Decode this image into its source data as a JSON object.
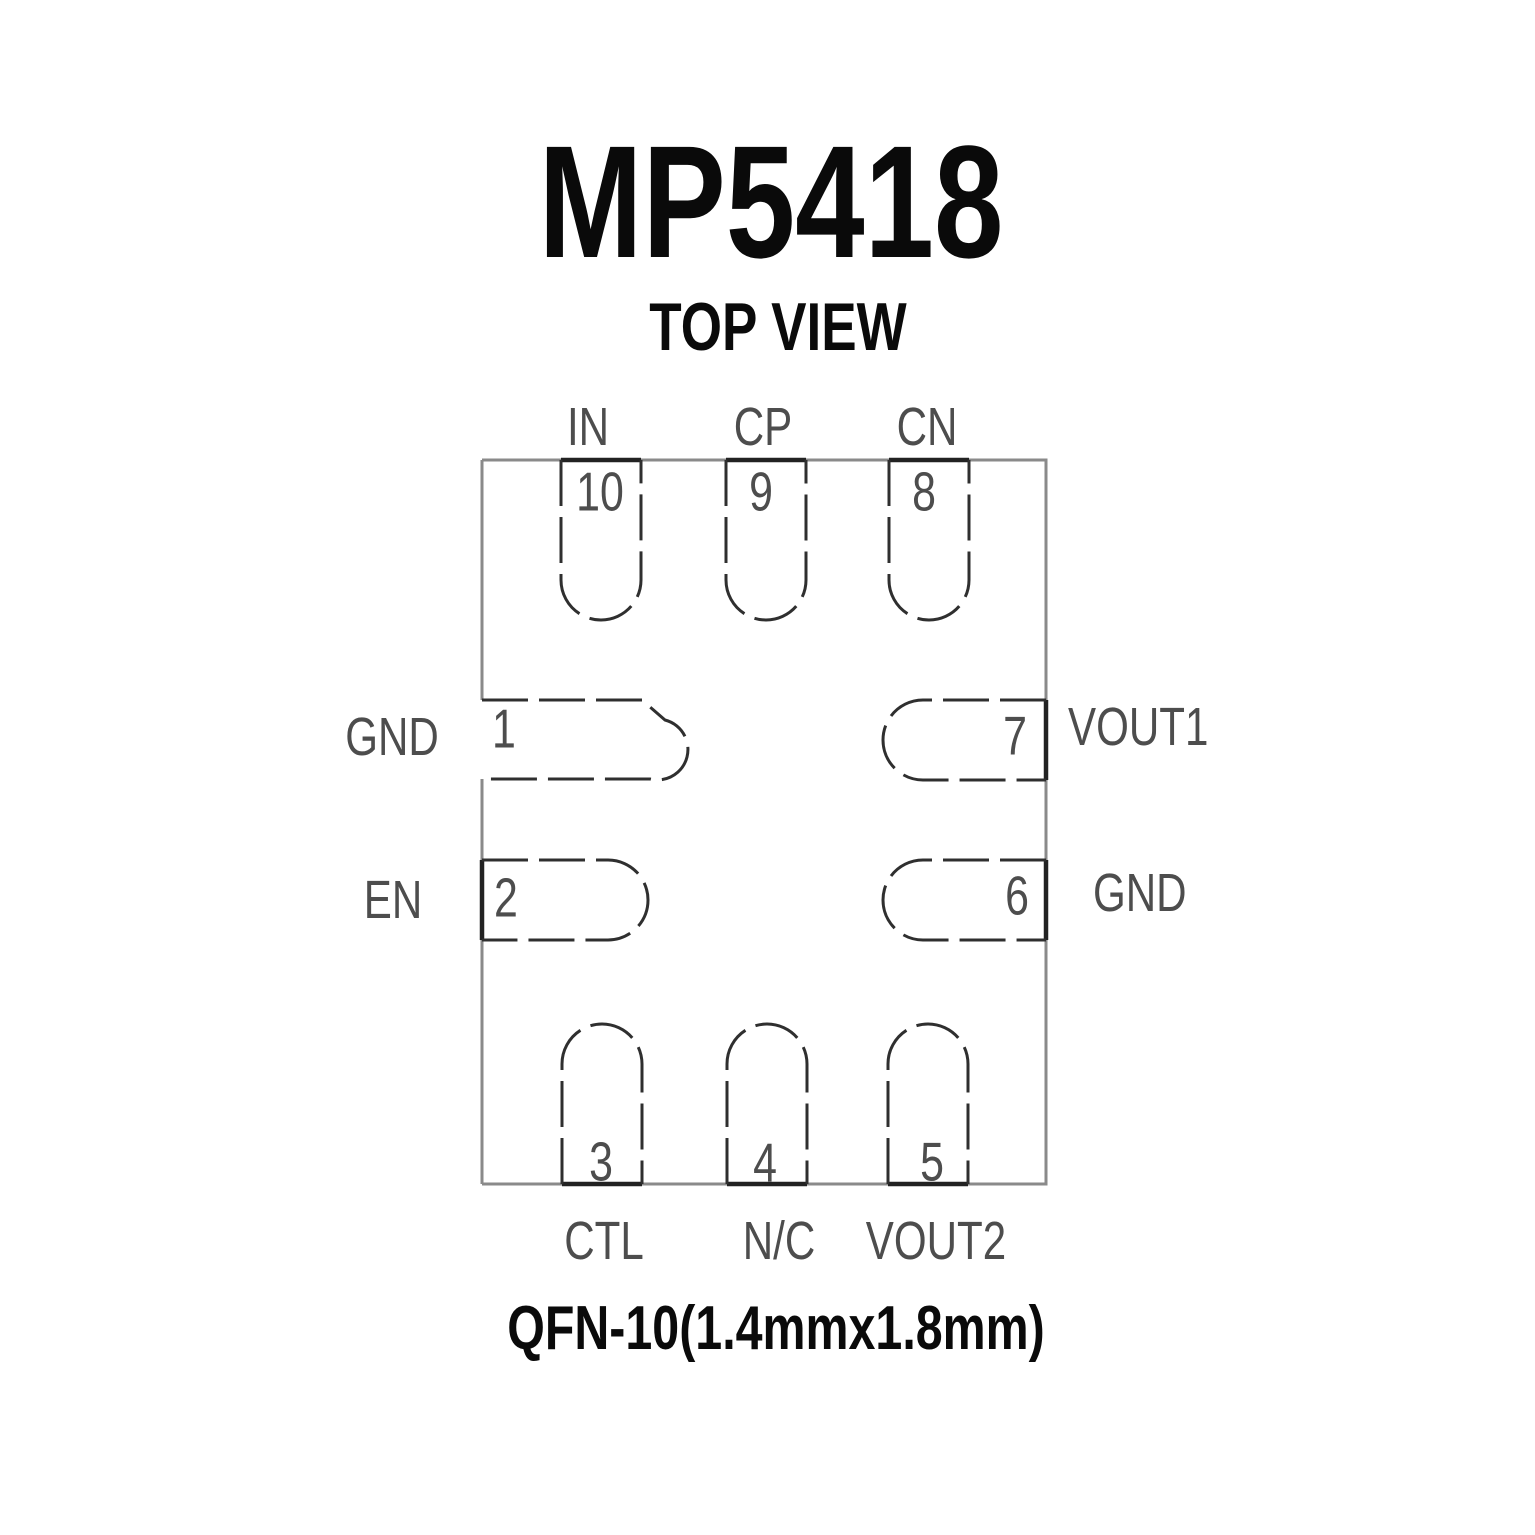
{
  "title": "MP5418",
  "view_label": "TOP VIEW",
  "package_label": "QFN-10(1.4mmx1.8mm)",
  "package": {
    "type": "QFN-10",
    "pin_count": 10,
    "pins": [
      {
        "number": "1",
        "name": "GND",
        "side": "left"
      },
      {
        "number": "2",
        "name": "EN",
        "side": "left"
      },
      {
        "number": "3",
        "name": "CTL",
        "side": "bottom"
      },
      {
        "number": "4",
        "name": "N/C",
        "side": "bottom"
      },
      {
        "number": "5",
        "name": "VOUT2",
        "side": "bottom"
      },
      {
        "number": "6",
        "name": "GND",
        "side": "right"
      },
      {
        "number": "7",
        "name": "VOUT1",
        "side": "right"
      },
      {
        "number": "8",
        "name": "CN",
        "side": "top"
      },
      {
        "number": "9",
        "name": "CP",
        "side": "top"
      },
      {
        "number": "10",
        "name": "IN",
        "side": "top"
      }
    ]
  },
  "colors": {
    "background": "#ffffff",
    "heading_text": "#0a0a0a",
    "label_text": "#4d4d4d",
    "pin_line": "#2f2f2f",
    "outline_line": "#8a8a8a",
    "pad_edge_line": "#222222"
  }
}
